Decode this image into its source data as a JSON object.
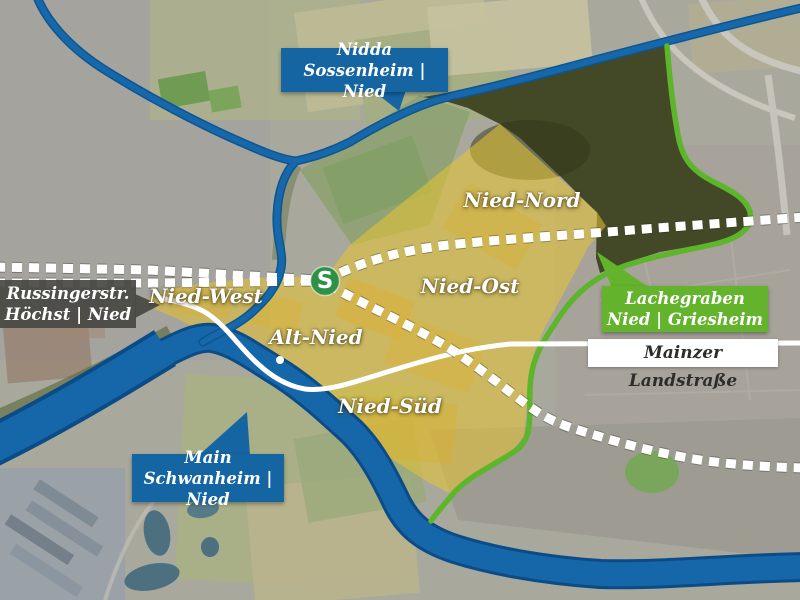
{
  "map": {
    "callouts": {
      "nidda": {
        "line1": "Nidda",
        "line2": "Sossenheim | Nied"
      },
      "russingerstrasse": {
        "line1": "Russingerstr.",
        "line2": "Höchst | Nied"
      },
      "lachegraben": {
        "line1": "Lachegraben",
        "line2": "Nied | Griesheim"
      },
      "main": {
        "line1": "Main",
        "line2": "Schwanheim | Nied"
      }
    },
    "road_label": "Mainzer Landstraße",
    "districts": [
      {
        "name": "Nied-Nord"
      },
      {
        "name": "Nied-Ost"
      },
      {
        "name": "Nied-West"
      },
      {
        "name": "Alt-Nied"
      },
      {
        "name": "Nied-Süd"
      }
    ],
    "station_symbol": "S",
    "colors": {
      "river": "#1667a9",
      "river_casing": "#0c4c86",
      "boundary_green": "#5db52c",
      "district_overlay": "#e7c52f",
      "callout_blue": "#1565a3",
      "callout_dark": "#484844",
      "callout_green": "#64b32c",
      "sbahn_green": "#2e9146",
      "forest": "#3b421e",
      "rail_white": "#ffffff",
      "road_white": "#ffffff"
    }
  }
}
